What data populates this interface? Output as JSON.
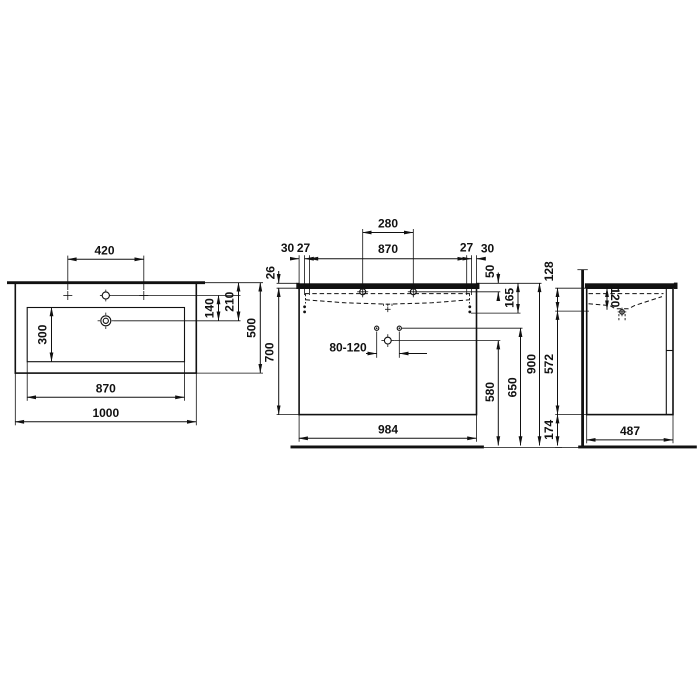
{
  "title": "vanity-washbasin-dimension-drawing",
  "views": {
    "top": {
      "tap_spacing": "420",
      "tap_to_drain": "140",
      "back_to_drain": "210",
      "bowl_depth": "300",
      "bowl_width": "870",
      "total_width": "1000",
      "total_depth": "500"
    },
    "front": {
      "tap_distance": "280",
      "edge_left": "30",
      "inset_left": "27",
      "bowl_width": "870",
      "inset_right": "27",
      "edge_right": "30",
      "worktop_thickness": "26",
      "tap_height": "50",
      "overflow_depth": "165",
      "siphon_range": "80-120",
      "siphon_height": "580",
      "fixing_height": "650",
      "cabinet_height": "700",
      "total_height": "900",
      "cabinet_width": "984"
    },
    "side": {
      "front_height": "128",
      "bowl_inner_depth": "120",
      "cabinet_height": "572",
      "floor_clearance": "174",
      "cabinet_depth": "487"
    }
  }
}
